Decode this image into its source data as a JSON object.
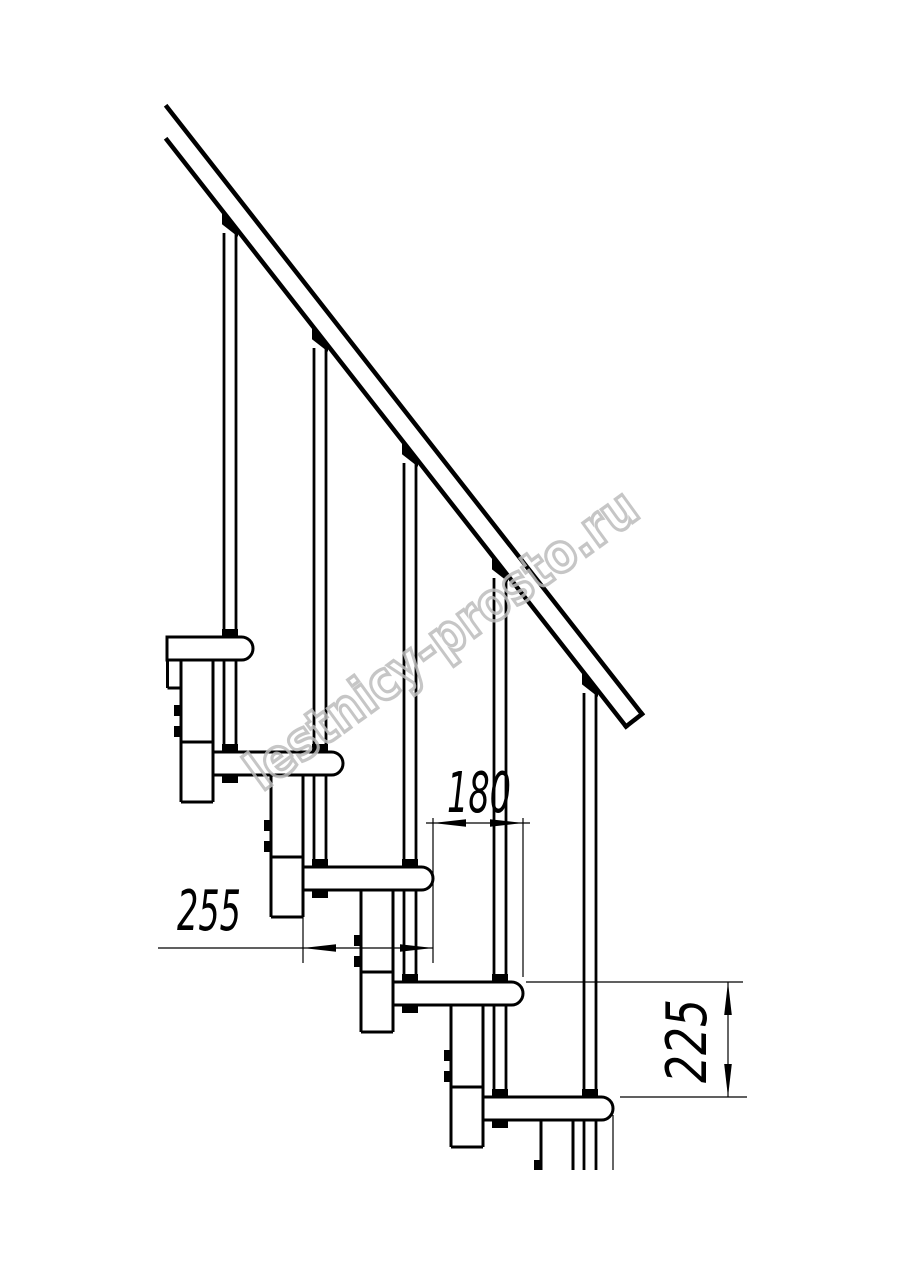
{
  "drawing": {
    "type": "staircase-side-elevation",
    "watermark": "lestnicy-prosto.ru",
    "dimensions": {
      "tread_depth": "255",
      "step_going": "180",
      "step_rise": "225"
    },
    "colors": {
      "line": "#000000",
      "dimension": "#000000",
      "watermark": "#bdbdbd",
      "background": "#ffffff"
    },
    "parts": {
      "handrail": "handrail",
      "baluster": "baluster",
      "tread": "tread",
      "column": "support-column"
    }
  }
}
